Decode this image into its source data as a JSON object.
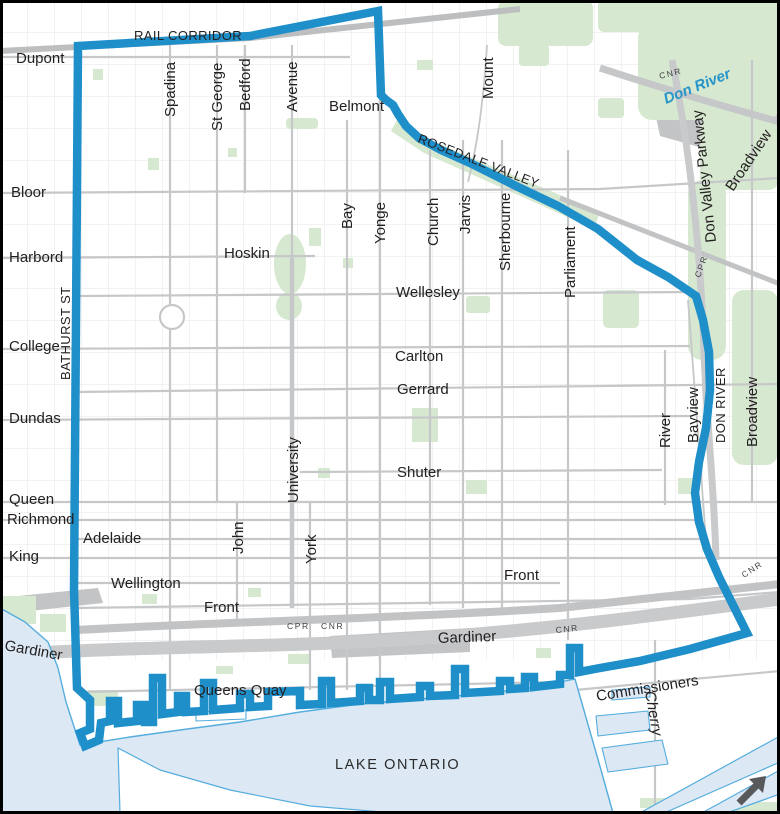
{
  "map": {
    "name": "downtown-boundary-map",
    "colors": {
      "background": "#FFFFFF",
      "boundary": "#1F8FCA",
      "water_fill": "#DCE8F4",
      "water_stroke": "#55ADDE",
      "park": "#D6E8CF",
      "road": "#C6C7C9",
      "road_dark": "#BFC1C3",
      "label": "#231F20",
      "river": "#2795C9",
      "arrow": "#58595B",
      "frame": "#000000"
    },
    "labels": [
      {
        "id": "rail-corridor",
        "text": "RAIL CORRIDOR",
        "x": 134,
        "y": 40,
        "rot": 0,
        "cls": "caps"
      },
      {
        "id": "dupont",
        "text": "Dupont",
        "x": 16,
        "y": 63,
        "rot": 0,
        "cls": "lbl"
      },
      {
        "id": "bloor",
        "text": "Bloor",
        "x": 11,
        "y": 197,
        "rot": 0,
        "cls": "lbl"
      },
      {
        "id": "harbord",
        "text": "Harbord",
        "x": 9,
        "y": 262,
        "rot": 0,
        "cls": "lbl"
      },
      {
        "id": "bathurst-st",
        "text": "BATHURST ST",
        "x": 70,
        "y": 380,
        "rot": -90,
        "cls": "caps"
      },
      {
        "id": "college",
        "text": "College",
        "x": 9,
        "y": 351,
        "rot": 0,
        "cls": "lbl"
      },
      {
        "id": "dundas",
        "text": "Dundas",
        "x": 9,
        "y": 423,
        "rot": 0,
        "cls": "lbl"
      },
      {
        "id": "queen",
        "text": "Queen",
        "x": 9,
        "y": 504,
        "rot": 0,
        "cls": "lbl"
      },
      {
        "id": "richmond",
        "text": "Richmond",
        "x": 7,
        "y": 524,
        "rot": 0,
        "cls": "lbl"
      },
      {
        "id": "king",
        "text": "King",
        "x": 9,
        "y": 561,
        "rot": 0,
        "cls": "lbl"
      },
      {
        "id": "adelaide",
        "text": "Adelaide",
        "x": 83,
        "y": 543,
        "rot": 0,
        "cls": "lbl"
      },
      {
        "id": "wellington",
        "text": "Wellington",
        "x": 111,
        "y": 588,
        "rot": 0,
        "cls": "lbl"
      },
      {
        "id": "front-west",
        "text": "Front",
        "x": 204,
        "y": 612,
        "rot": 0,
        "cls": "lbl"
      },
      {
        "id": "gardiner-west",
        "text": "Gardiner",
        "x": 4,
        "y": 650,
        "rot": 10,
        "cls": "lbl"
      },
      {
        "id": "spadina",
        "text": "Spadina",
        "x": 175,
        "y": 117,
        "rot": -90,
        "cls": "lbl"
      },
      {
        "id": "st-george",
        "text": "St George",
        "x": 222,
        "y": 131,
        "rot": -90,
        "cls": "lbl"
      },
      {
        "id": "bedford",
        "text": "Bedford",
        "x": 250,
        "y": 111,
        "rot": -90,
        "cls": "lbl"
      },
      {
        "id": "avenue",
        "text": "Avenue",
        "x": 297,
        "y": 112,
        "rot": -90,
        "cls": "lbl"
      },
      {
        "id": "belmont",
        "text": "Belmont",
        "x": 329,
        "y": 111,
        "rot": 0,
        "cls": "lbl"
      },
      {
        "id": "mount",
        "text": "Mount",
        "x": 493,
        "y": 99,
        "rot": -90,
        "cls": "lbl"
      },
      {
        "id": "rosedale-valley",
        "text": "ROSEDALE VALLEY",
        "x": 417,
        "y": 142,
        "rot": 21,
        "cls": "caps"
      },
      {
        "id": "cnr-top",
        "text": "CNR",
        "x": 660,
        "y": 79,
        "rot": -14,
        "cls": "small"
      },
      {
        "id": "don-river",
        "text": "Don River",
        "x": 666,
        "y": 104,
        "rot": -22,
        "cls": "river"
      },
      {
        "id": "don-valley-parkway",
        "text": "Don Valley Parkway",
        "x": 716,
        "y": 242,
        "rot": -96,
        "cls": "lbl"
      },
      {
        "id": "broadview-north",
        "text": "Broadview",
        "x": 733,
        "y": 192,
        "rot": -56,
        "cls": "lbl"
      },
      {
        "id": "hoskin",
        "text": "Hoskin",
        "x": 224,
        "y": 258,
        "rot": 0,
        "cls": "lbl"
      },
      {
        "id": "bay",
        "text": "Bay",
        "x": 352,
        "y": 229,
        "rot": -90,
        "cls": "lbl"
      },
      {
        "id": "yonge",
        "text": "Yonge",
        "x": 385,
        "y": 244,
        "rot": -90,
        "cls": "lbl"
      },
      {
        "id": "church",
        "text": "Church",
        "x": 438,
        "y": 246,
        "rot": -90,
        "cls": "lbl"
      },
      {
        "id": "jarvis",
        "text": "Jarvis",
        "x": 470,
        "y": 234,
        "rot": -90,
        "cls": "lbl"
      },
      {
        "id": "sherbourne",
        "text": "Sherbourne",
        "x": 510,
        "y": 271,
        "rot": -90,
        "cls": "lbl"
      },
      {
        "id": "parliament",
        "text": "Parliament",
        "x": 575,
        "y": 298,
        "rot": -90,
        "cls": "lbl"
      },
      {
        "id": "wellesley",
        "text": "Wellesley",
        "x": 396,
        "y": 297,
        "rot": 0,
        "cls": "lbl"
      },
      {
        "id": "carlton",
        "text": "Carlton",
        "x": 395,
        "y": 361,
        "rot": 0,
        "cls": "lbl"
      },
      {
        "id": "gerrard",
        "text": "Gerrard",
        "x": 397,
        "y": 394,
        "rot": 0,
        "cls": "lbl"
      },
      {
        "id": "shuter",
        "text": "Shuter",
        "x": 397,
        "y": 477,
        "rot": 0,
        "cls": "lbl"
      },
      {
        "id": "cpr-northeast",
        "text": "CPR",
        "x": 700,
        "y": 278,
        "rot": -70,
        "cls": "small"
      },
      {
        "id": "university",
        "text": "University",
        "x": 298,
        "y": 503,
        "rot": -90,
        "cls": "lbl"
      },
      {
        "id": "river-st",
        "text": "River",
        "x": 670,
        "y": 448,
        "rot": -90,
        "cls": "lbl"
      },
      {
        "id": "bayview",
        "text": "Bayview",
        "x": 698,
        "y": 443,
        "rot": -90,
        "cls": "lbl"
      },
      {
        "id": "don-river-caps",
        "text": "DON RIVER",
        "x": 725,
        "y": 443,
        "rot": -90,
        "cls": "caps"
      },
      {
        "id": "broadview-south",
        "text": "Broadview",
        "x": 757,
        "y": 447,
        "rot": -90,
        "cls": "lbl"
      },
      {
        "id": "john",
        "text": "John",
        "x": 243,
        "y": 554,
        "rot": -90,
        "cls": "lbl"
      },
      {
        "id": "york",
        "text": "York",
        "x": 316,
        "y": 564,
        "rot": -90,
        "cls": "lbl"
      },
      {
        "id": "front-east",
        "text": "Front",
        "x": 504,
        "y": 580,
        "rot": 0,
        "cls": "lbl"
      },
      {
        "id": "cpr-south",
        "text": "CPR",
        "x": 287,
        "y": 629,
        "rot": 0,
        "cls": "small"
      },
      {
        "id": "cnr-south",
        "text": "CNR",
        "x": 321,
        "y": 629,
        "rot": 0,
        "cls": "small"
      },
      {
        "id": "gardiner-centre",
        "text": "Gardiner",
        "x": 438,
        "y": 643,
        "rot": -2,
        "cls": "lbl"
      },
      {
        "id": "cnr-mid",
        "text": "CNR",
        "x": 556,
        "y": 633,
        "rot": -6,
        "cls": "small"
      },
      {
        "id": "queens-quay",
        "text": "Queens Quay",
        "x": 194,
        "y": 695,
        "rot": 0,
        "cls": "lbl"
      },
      {
        "id": "cnr-east",
        "text": "CNR",
        "x": 744,
        "y": 578,
        "rot": -33,
        "cls": "small"
      },
      {
        "id": "commissioners",
        "text": "Commissioners",
        "x": 597,
        "y": 701,
        "rot": -9,
        "cls": "lbl"
      },
      {
        "id": "cherry",
        "text": "Cherry",
        "x": 645,
        "y": 692,
        "rot": 80,
        "cls": "it"
      },
      {
        "id": "lake-ontario",
        "text": "LAKE ONTARIO",
        "x": 335,
        "y": 769,
        "rot": 0,
        "cls": "water-lbl"
      }
    ],
    "north_arrow": {
      "icon": "north-arrow-icon",
      "direction": "up-right"
    }
  }
}
